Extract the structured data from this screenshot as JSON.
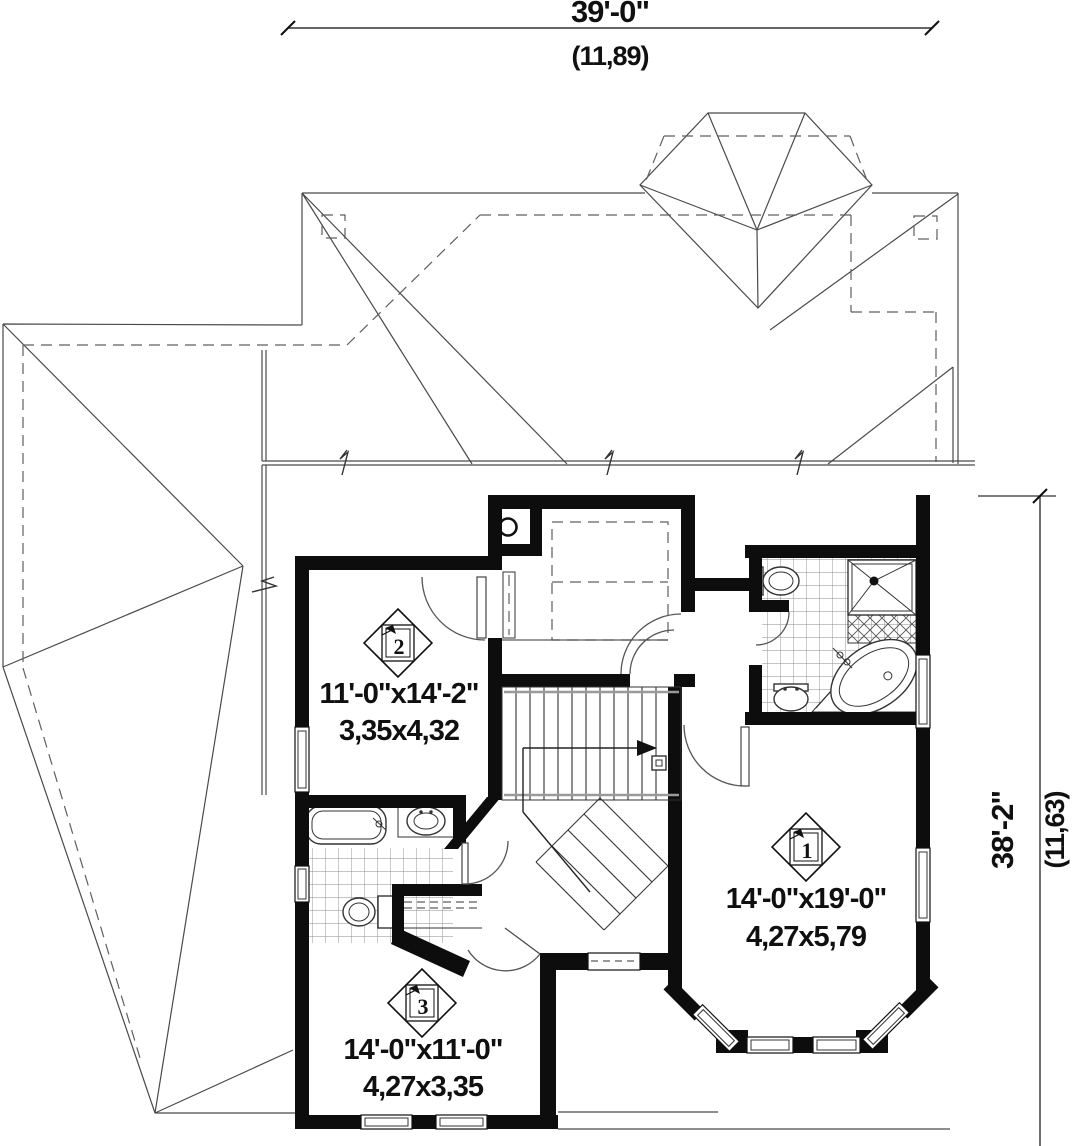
{
  "dimensions": {
    "top": {
      "imperial": "39'-0\"",
      "metric": "(11,89)"
    },
    "right": {
      "imperial": "38'-2\"",
      "metric": "(11,63)"
    }
  },
  "rooms": [
    {
      "number": "1",
      "imperial": "14'-0\"x19'-0\"",
      "metric": "4,27x5,79"
    },
    {
      "number": "2",
      "imperial": "11'-0\"x14'-2\"",
      "metric": "3,35x4,32"
    },
    {
      "number": "3",
      "imperial": "14'-0\"x11'-0\"",
      "metric": "4,27x3,35"
    }
  ],
  "colors": {
    "wall": "#0d0d0d",
    "line": "#4a4a4a",
    "background": "#ffffff"
  }
}
